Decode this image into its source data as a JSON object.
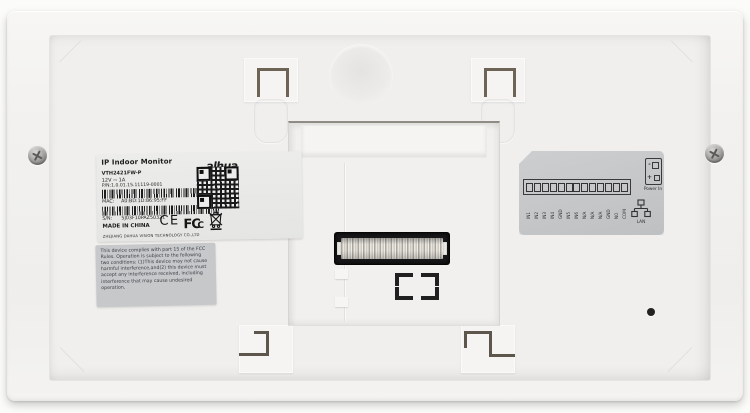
{
  "device": {
    "type": "ip-indoor-monitor-rear-panel"
  },
  "product_label": {
    "title": "IP Indoor Monitor",
    "brand": "alhua",
    "brand_sub": "TECHNOLOGY",
    "model": "VTH2421FW-P",
    "power_rating": "12V ⎓ 1A",
    "pn": "P/N:1.0.01.15.11119-0001",
    "mac_label": "MAC:",
    "mac_value": "A0:BD:1D:86:95:FF",
    "sn_label": "S/N:",
    "sn_value": "5J03F10PAZ50321",
    "made_in": "MADE IN CHINA",
    "company": "ZHEJIANG DAHUA VISION TECHNOLOGY CO.,LTD",
    "ce_mark": "CE",
    "fcc_mark_main": "FC",
    "fcc_mark_sub": "C"
  },
  "fcc_label": {
    "text": "This device complies with part 15 of the FCC Rules. Operation is subject to the following two conditions: (1)This device may not cause harmful interference,and(2) this device must accept any interference received, including interference that may cause undesired operation."
  },
  "wiring_label": {
    "terminals": [
      "IN1",
      "IN2",
      "IN3",
      "IN4",
      "GND",
      "IN5",
      "IN6",
      "N/A",
      "N/A",
      "N/A",
      "GND",
      "NO",
      "COM"
    ],
    "power_in_label": "Power In",
    "power_minus": "-",
    "power_plus": "+",
    "lan_label": "LAN"
  },
  "colors": {
    "device_body": "#f2f1ef",
    "label_white": "#e9e9e7",
    "label_gray": "#c6c8ca",
    "hook_metal": "#5c564d",
    "connector_housing": "#18181a",
    "text_dark": "#1e1e1e"
  }
}
